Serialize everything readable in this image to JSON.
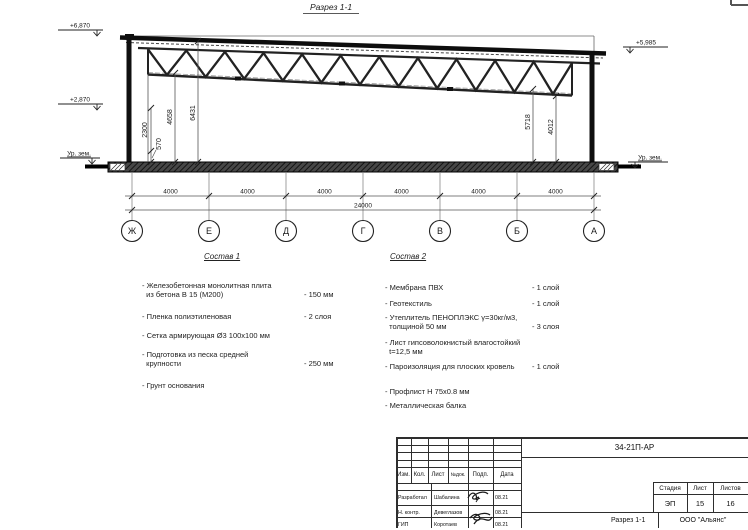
{
  "page": {
    "section_title": "Разрез 1-1"
  },
  "drawing": {
    "elevations": {
      "left_top": "+6,870",
      "left_mid": "+2,870",
      "ground_left": "Ур. зем.",
      "right_top": "+5,985",
      "ground_right": "Ур. зем."
    },
    "dims_left": [
      "2300",
      "570",
      "4658",
      "6431"
    ],
    "dims_right": [
      "5718",
      "4012"
    ],
    "axes": [
      "Ж",
      "Е",
      "Д",
      "Г",
      "В",
      "Б",
      "А"
    ],
    "spans": [
      "4000",
      "4000",
      "4000",
      "4000",
      "4000",
      "4000"
    ],
    "total_span": "24000"
  },
  "composition1": {
    "title": "Состав 1",
    "items": [
      {
        "name": "- Железобетонная  монолитная плита\n  из бетона В 15 (М200)",
        "value": "- 150 мм"
      },
      {
        "name": "- Пленка полиэтиленовая",
        "value": "- 2 слоя"
      },
      {
        "name": "- Сетка армирующая Ø3 100х100 мм",
        "value": ""
      },
      {
        "name": "- Подготовка из песка средней\n  крупности",
        "value": "- 250 мм"
      },
      {
        "name": "- Грунт основания",
        "value": ""
      }
    ]
  },
  "composition2": {
    "title": "Состав 2",
    "items": [
      {
        "name": "- Мембрана ПВХ",
        "value": "- 1 слой"
      },
      {
        "name": "- Геотекстиль",
        "value": "- 1 слой"
      },
      {
        "name": "- Утеплитель ПЕНОПЛЭКС γ=30кг/м3,\n  толщиной 50 мм",
        "value": "- 3 слоя"
      },
      {
        "name": "- Лист гипсоволокнистый влагостойкий\n  t=12,5 мм",
        "value": ""
      },
      {
        "name": "- Пароизоляция для плоских кровель",
        "value": "- 1 слой"
      },
      {
        "name": "- Профлист Н 75х0.8 мм",
        "value": ""
      },
      {
        "name": "- Металлическая балка",
        "value": ""
      }
    ]
  },
  "titleblock": {
    "doc_number": "34-21П-АР",
    "columns": [
      "Изм.",
      "Кол.",
      "Лист",
      "№док.",
      "Подп.",
      "Дата"
    ],
    "signature_rows": [
      {
        "role": "Разработал",
        "name": "Шабалина",
        "date": "08.21"
      },
      {
        "role": "Н. контр.",
        "name": "Девеглазов",
        "date": "08.21"
      },
      {
        "role": "ГИП",
        "name": "Коротаев",
        "date": "08.21"
      }
    ],
    "stage_label": "Стадия",
    "sheet_label": "Лист",
    "sheets_label": "Листов",
    "stage": "ЭП",
    "sheet": "15",
    "sheets": "16",
    "drawing_title": "Разрез 1-1",
    "company": "ООО \"Альянс\""
  }
}
